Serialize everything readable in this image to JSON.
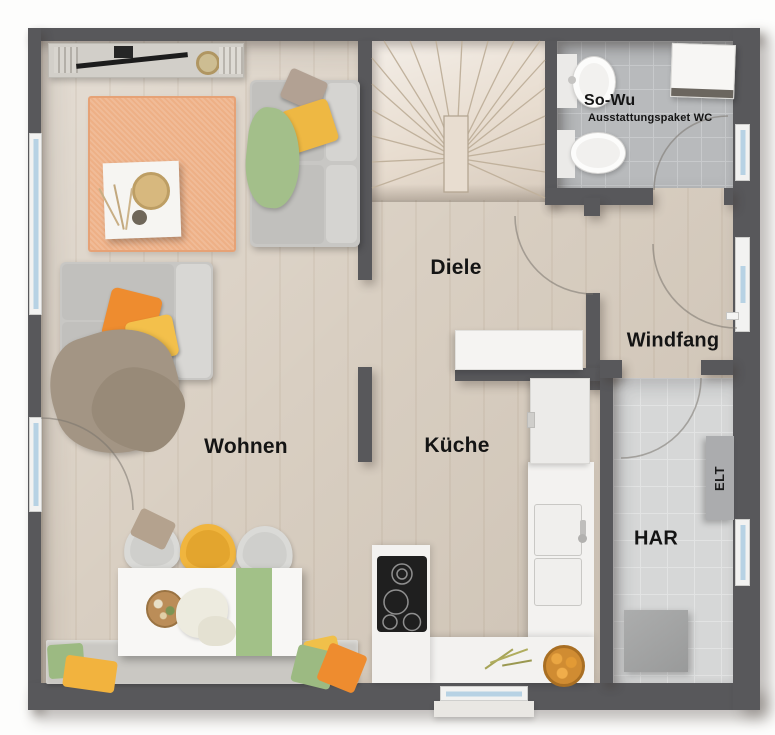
{
  "rooms": {
    "wohnen": {
      "label": "Wohnen"
    },
    "diele": {
      "label": "Diele"
    },
    "kueche": {
      "label": "Küche"
    },
    "windfang": {
      "label": "Windfang"
    },
    "har": {
      "label": "HAR"
    }
  },
  "bathroom": {
    "name": "So-Wu",
    "package": "Ausstattungspaket WC"
  },
  "electrical_cabinet": {
    "label": "ELT"
  },
  "colors": {
    "wall": "#58585b",
    "wood_floor": "#d9cfc2",
    "stair_wood": "#e8ddd0",
    "bath_tile": "#b8babc",
    "har_tile": "#d6d7d7",
    "rug": "#eeb086",
    "accent_orange": "#ee8c2f",
    "accent_yellow": "#f0b53e",
    "accent_green": "#9cba82",
    "window_glass": "#b7d2e4"
  }
}
